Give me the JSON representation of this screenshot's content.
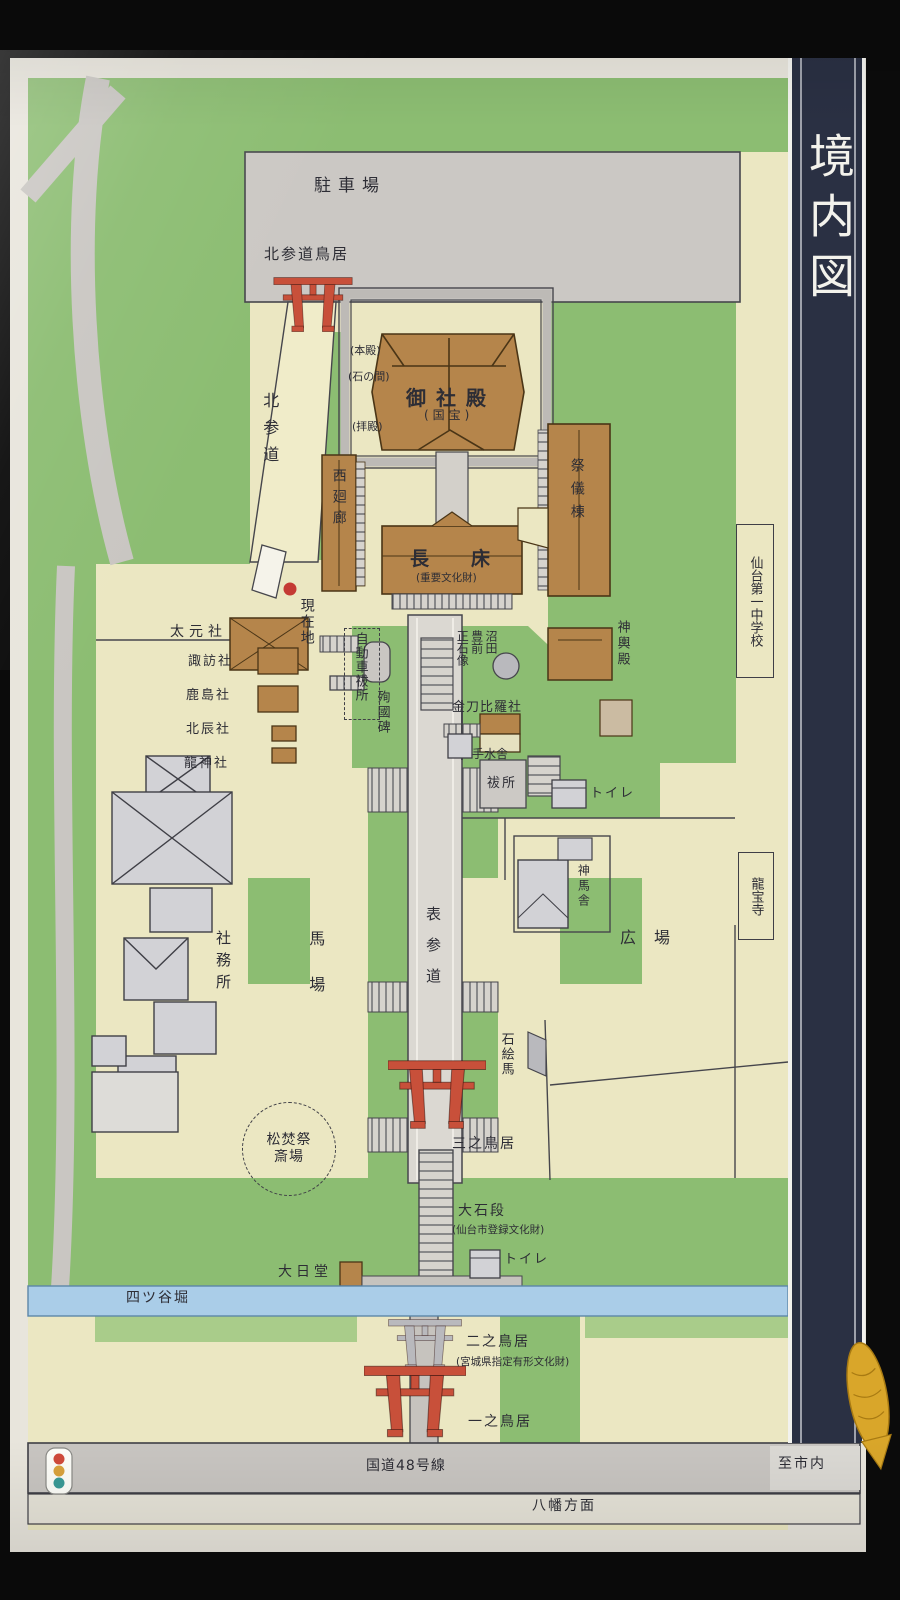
{
  "board": {
    "title_band": "境内図"
  },
  "palette": {
    "photo_black": "#0b0b0b",
    "frame": "#e8e5dc",
    "paper": "#ebe7c2",
    "green": "#8cbd72",
    "green_light": "#a9cc8a",
    "gray_area": "#cbc8c4",
    "road_gray": "#c8c5c1",
    "building_gray": "#d2d2d6",
    "building_brown": "#b5854b",
    "torii_red": "#c8503a",
    "stone_gray": "#b9b9bd",
    "water_blue": "#aacde8",
    "band_navy": "#2a3043",
    "ink": "#2d2d35",
    "current_location_red": "#c43a33",
    "koi_gold": "#d9a62a"
  },
  "labels": {
    "parking": "駐車場",
    "kita_sando_torii": "北参道鳥居",
    "kita_sando": "北参道",
    "honden": "(本殿)",
    "ishinoma": "(石の間)",
    "haiden": "(拝殿)",
    "goshaden": "御社殿",
    "kokuho": "(国宝)",
    "nishi_kairo": "西廻廊",
    "nagatoko": "長床",
    "nagatoko_note": "(重要文化財)",
    "saigito": "祭儀棟",
    "school": "仙台第一中学校",
    "shinyoden": "神輿殿",
    "genzaichi": "現在地",
    "daigensha": "太元社",
    "suwasha": "諏訪社",
    "kashimasha": "鹿島社",
    "hokushinsha": "北辰社",
    "ryujinsha": "龍神社",
    "jidosha_haraisho": "自動車祓所",
    "junkokuhi": "殉國碑",
    "numata_statue": "沼田\n豊前\n正石像",
    "kotohirasha": "金刀比羅社",
    "temizusha": "手水舎",
    "haraisho": "祓所",
    "toilet_upper": "トイレ",
    "shinmesha": "神馬舎",
    "ryuhoji": "龍宝寺",
    "shamusho": "社務所",
    "baba": "馬場",
    "omote_sando": "表参道",
    "hiroba": "広場",
    "ishi_ema": "石絵馬",
    "san_no_torii": "三之鳥居",
    "matsutakisai": "松焚祭\n斎場",
    "oishidan": "大石段",
    "oishidan_note": "(仙台市登録文化財)",
    "dainichido": "大日堂",
    "toilet_lower": "トイレ",
    "yotsuyabori": "四ツ谷堀",
    "ni_no_torii": "二之鳥居",
    "ni_no_torii_note": "(宮城県指定有形文化財)",
    "ichi_no_torii": "一之鳥居",
    "route48": "国道48号線",
    "to_city": "至市内",
    "hachiman_homen": "八幡方面"
  },
  "icons": {
    "current_location": "red-dot",
    "traffic_signal": "traffic-light",
    "decoration": "golden-koi"
  }
}
